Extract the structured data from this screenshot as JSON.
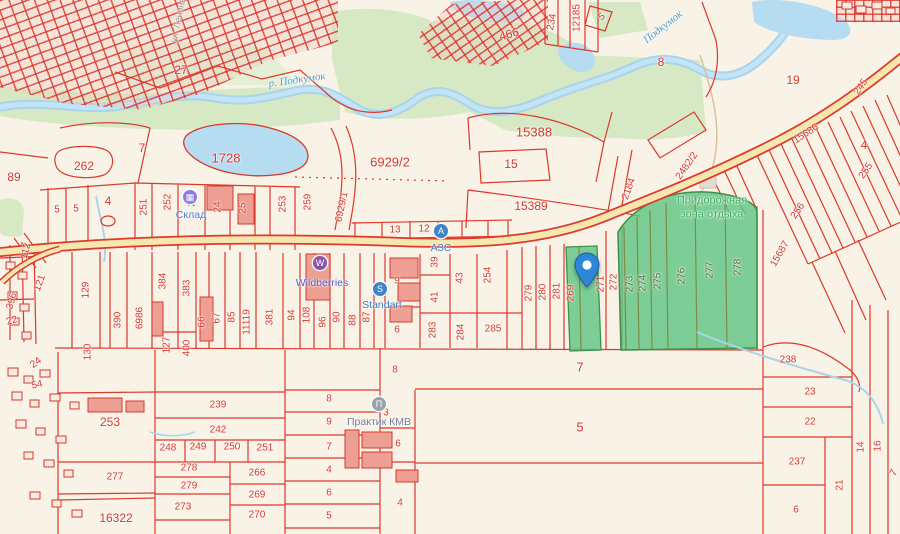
{
  "map": {
    "colors": {
      "parcel_line": "#dd382c",
      "parcel_label": "#d6382e",
      "highlight_green": "#61c584",
      "water": "#b6dcf2",
      "road_fill": "#f6e7b0",
      "vegetation": "#d6e9c4"
    },
    "street_label": "ул. Ленина",
    "river_labels": [
      {
        "text": "р. Подкумок"
      },
      {
        "text": "Подкумок"
      }
    ],
    "rest_area": {
      "line1": "Придорожная",
      "line2": "зона отдыха"
    },
    "pin": {
      "x": 587,
      "y": 287
    },
    "pois": [
      {
        "id": "sklad",
        "label": "Склад",
        "glyph": "▦",
        "bg": "#8d7ae0",
        "ix": 190,
        "iy": 197,
        "lx": 191,
        "ly": 215,
        "lc": "#4a7bd0"
      },
      {
        "id": "wildberries",
        "label": "Wildberries",
        "glyph": "W",
        "bg": "#8a55a8",
        "ix": 320,
        "iy": 263,
        "lx": 322,
        "ly": 283,
        "lc": "#5558cf"
      },
      {
        "id": "standart",
        "label": "Standart",
        "glyph": "S",
        "bg": "#3d85c8",
        "ix": 380,
        "iy": 289,
        "lx": 382,
        "ly": 305,
        "lc": "#3f78c8"
      },
      {
        "id": "azs",
        "label": "АЗС",
        "glyph": "А",
        "bg": "#3d85c8",
        "ix": 441,
        "iy": 231,
        "lx": 441,
        "ly": 248,
        "lc": "#3f78c8"
      },
      {
        "id": "praktik",
        "label": "Практик КМВ",
        "glyph": "П",
        "bg": "#9aa3ac",
        "ix": 379,
        "iy": 404,
        "lx": 379,
        "ly": 422,
        "lc": "#6e7d92"
      }
    ],
    "parcel_labels": [
      {
        "t": "27",
        "x": 181,
        "y": 70,
        "s": 12
      },
      {
        "t": "7",
        "x": 142,
        "y": 148,
        "s": 12
      },
      {
        "t": "262",
        "x": 84,
        "y": 166,
        "s": 12
      },
      {
        "t": "89",
        "x": 14,
        "y": 177,
        "s": 12
      },
      {
        "t": "5",
        "x": 57,
        "y": 210
      },
      {
        "t": "5",
        "x": 76,
        "y": 209
      },
      {
        "t": "4",
        "x": 108,
        "y": 201,
        "s": 12
      },
      {
        "t": "1728",
        "x": 226,
        "y": 158,
        "s": 13
      },
      {
        "t": "6929/2",
        "x": 390,
        "y": 162,
        "s": 13
      },
      {
        "t": "15388",
        "x": 534,
        "y": 132,
        "s": 13
      },
      {
        "t": "15",
        "x": 511,
        "y": 164,
        "s": 12
      },
      {
        "t": "15389",
        "x": 531,
        "y": 206,
        "s": 12
      },
      {
        "t": "13",
        "x": 395,
        "y": 230
      },
      {
        "t": "12",
        "x": 424,
        "y": 229
      },
      {
        "t": "8",
        "x": 661,
        "y": 62,
        "s": 12
      },
      {
        "t": "19",
        "x": 793,
        "y": 80,
        "s": 12
      },
      {
        "t": "466",
        "x": 509,
        "y": 34,
        "r": -15,
        "s": 12
      },
      {
        "t": "234",
        "x": 552,
        "y": 22,
        "r": -80
      },
      {
        "t": "12185",
        "x": 577,
        "y": 18,
        "r": -90
      },
      {
        "t": "5",
        "x": 602,
        "y": 17,
        "r": -35
      },
      {
        "t": "245",
        "x": 861,
        "y": 87,
        "r": -55
      },
      {
        "t": "15686",
        "x": 806,
        "y": 134,
        "r": -33
      },
      {
        "t": "4",
        "x": 864,
        "y": 145,
        "s": 12
      },
      {
        "t": "255",
        "x": 866,
        "y": 171,
        "r": -55
      },
      {
        "t": "256",
        "x": 798,
        "y": 211,
        "r": -55
      },
      {
        "t": "15687",
        "x": 780,
        "y": 254,
        "r": -60
      },
      {
        "t": "2482/2",
        "x": 687,
        "y": 166,
        "r": -55
      },
      {
        "t": "2184",
        "x": 629,
        "y": 189,
        "r": -70
      },
      {
        "t": "251",
        "x": 144,
        "y": 207,
        "r": -90
      },
      {
        "t": "252",
        "x": 168,
        "y": 202,
        "r": -90
      },
      {
        "t": "23",
        "x": 192,
        "y": 201,
        "r": -90
      },
      {
        "t": "24",
        "x": 218,
        "y": 207,
        "r": -90
      },
      {
        "t": "25",
        "x": 243,
        "y": 208,
        "r": -90
      },
      {
        "t": "253",
        "x": 283,
        "y": 204,
        "r": -90
      },
      {
        "t": "259",
        "x": 308,
        "y": 202,
        "r": -90
      },
      {
        "t": "6929/1",
        "x": 342,
        "y": 207,
        "r": -78
      },
      {
        "t": "112",
        "x": 26,
        "y": 251,
        "r": -75
      },
      {
        "t": "121",
        "x": 40,
        "y": 283,
        "r": -70
      },
      {
        "t": "396",
        "x": 12,
        "y": 301,
        "r": -75
      },
      {
        "t": "22",
        "x": 12,
        "y": 321,
        "r": -15
      },
      {
        "t": "129",
        "x": 86,
        "y": 290,
        "r": -90
      },
      {
        "t": "390",
        "x": 118,
        "y": 320,
        "r": -90
      },
      {
        "t": "6986",
        "x": 140,
        "y": 318,
        "r": -90
      },
      {
        "t": "384",
        "x": 163,
        "y": 281,
        "r": -90
      },
      {
        "t": "383",
        "x": 187,
        "y": 288,
        "r": -90
      },
      {
        "t": "127",
        "x": 167,
        "y": 345,
        "r": -90
      },
      {
        "t": "400",
        "x": 187,
        "y": 348,
        "r": -90
      },
      {
        "t": "66",
        "x": 202,
        "y": 322,
        "r": -90
      },
      {
        "t": "67",
        "x": 217,
        "y": 318,
        "r": -90
      },
      {
        "t": "85",
        "x": 232,
        "y": 317,
        "r": -90
      },
      {
        "t": "11119",
        "x": 247,
        "y": 322,
        "r": -90
      },
      {
        "t": "381",
        "x": 270,
        "y": 317,
        "r": -90
      },
      {
        "t": "94",
        "x": 292,
        "y": 315,
        "r": -90
      },
      {
        "t": "108",
        "x": 307,
        "y": 315,
        "r": -90
      },
      {
        "t": "96",
        "x": 323,
        "y": 322,
        "r": -90
      },
      {
        "t": "90",
        "x": 337,
        "y": 317,
        "r": -90
      },
      {
        "t": "88",
        "x": 353,
        "y": 320,
        "r": -90
      },
      {
        "t": "87",
        "x": 367,
        "y": 317,
        "r": -90
      },
      {
        "t": "9",
        "x": 397,
        "y": 281
      },
      {
        "t": "6",
        "x": 397,
        "y": 330
      },
      {
        "t": "39",
        "x": 435,
        "y": 262,
        "r": -90
      },
      {
        "t": "41",
        "x": 435,
        "y": 297,
        "r": -90
      },
      {
        "t": "43",
        "x": 460,
        "y": 278,
        "r": -90
      },
      {
        "t": "254",
        "x": 488,
        "y": 275,
        "r": -90
      },
      {
        "t": "283",
        "x": 433,
        "y": 330,
        "r": -90
      },
      {
        "t": "284",
        "x": 461,
        "y": 332,
        "r": -90
      },
      {
        "t": "285",
        "x": 493,
        "y": 329
      },
      {
        "t": "279",
        "x": 529,
        "y": 293,
        "r": -90
      },
      {
        "t": "280",
        "x": 543,
        "y": 292,
        "r": -90
      },
      {
        "t": "281",
        "x": 557,
        "y": 291,
        "r": -90
      },
      {
        "t": "269",
        "x": 571,
        "y": 293,
        "r": -90
      },
      {
        "t": "271",
        "x": 601,
        "y": 284,
        "r": -90
      },
      {
        "t": "272",
        "x": 614,
        "y": 282,
        "r": -90
      },
      {
        "t": "273",
        "x": 630,
        "y": 284,
        "r": -90,
        "c": "olive"
      },
      {
        "t": "274",
        "x": 643,
        "y": 283,
        "r": -90,
        "c": "olive"
      },
      {
        "t": "275",
        "x": 658,
        "y": 281,
        "r": -90,
        "c": "olive"
      },
      {
        "t": "276",
        "x": 682,
        "y": 276,
        "r": -90,
        "c": "olive"
      },
      {
        "t": "277",
        "x": 710,
        "y": 270,
        "r": -90,
        "c": "olive"
      },
      {
        "t": "278",
        "x": 738,
        "y": 267,
        "r": -90,
        "c": "olive"
      },
      {
        "t": "238",
        "x": 788,
        "y": 360
      },
      {
        "t": "23",
        "x": 810,
        "y": 392
      },
      {
        "t": "22",
        "x": 810,
        "y": 422
      },
      {
        "t": "237",
        "x": 797,
        "y": 462
      },
      {
        "t": "21",
        "x": 840,
        "y": 485,
        "r": -90
      },
      {
        "t": "14",
        "x": 861,
        "y": 447,
        "r": -90
      },
      {
        "t": "16",
        "x": 878,
        "y": 446,
        "r": -90
      },
      {
        "t": "6",
        "x": 796,
        "y": 510
      },
      {
        "t": "7",
        "x": 894,
        "y": 473,
        "r": -60
      },
      {
        "t": "7",
        "x": 580,
        "y": 367,
        "s": 13
      },
      {
        "t": "5",
        "x": 580,
        "y": 427,
        "s": 13
      },
      {
        "t": "8",
        "x": 395,
        "y": 370
      },
      {
        "t": "3",
        "x": 386,
        "y": 413
      },
      {
        "t": "6",
        "x": 398,
        "y": 444
      },
      {
        "t": "4",
        "x": 400,
        "y": 503
      },
      {
        "t": "8",
        "x": 329,
        "y": 399
      },
      {
        "t": "9",
        "x": 329,
        "y": 422
      },
      {
        "t": "7",
        "x": 329,
        "y": 447
      },
      {
        "t": "4",
        "x": 329,
        "y": 470
      },
      {
        "t": "6",
        "x": 329,
        "y": 493
      },
      {
        "t": "5",
        "x": 329,
        "y": 516
      },
      {
        "t": "239",
        "x": 218,
        "y": 405
      },
      {
        "t": "242",
        "x": 218,
        "y": 430
      },
      {
        "t": "248",
        "x": 168,
        "y": 448
      },
      {
        "t": "249",
        "x": 198,
        "y": 447
      },
      {
        "t": "250",
        "x": 232,
        "y": 447
      },
      {
        "t": "251",
        "x": 265,
        "y": 448
      },
      {
        "t": "278",
        "x": 189,
        "y": 468
      },
      {
        "t": "279",
        "x": 189,
        "y": 486
      },
      {
        "t": "266",
        "x": 257,
        "y": 473
      },
      {
        "t": "269",
        "x": 257,
        "y": 495
      },
      {
        "t": "270",
        "x": 257,
        "y": 515
      },
      {
        "t": "273",
        "x": 183,
        "y": 507
      },
      {
        "t": "277",
        "x": 115,
        "y": 477
      },
      {
        "t": "16322",
        "x": 116,
        "y": 518,
        "s": 12
      },
      {
        "t": "253",
        "x": 110,
        "y": 422,
        "s": 12
      },
      {
        "t": "54",
        "x": 37,
        "y": 385,
        "r": -12
      },
      {
        "t": "24",
        "x": 36,
        "y": 363,
        "r": -35
      },
      {
        "t": "130",
        "x": 88,
        "y": 352,
        "r": -90
      }
    ]
  }
}
